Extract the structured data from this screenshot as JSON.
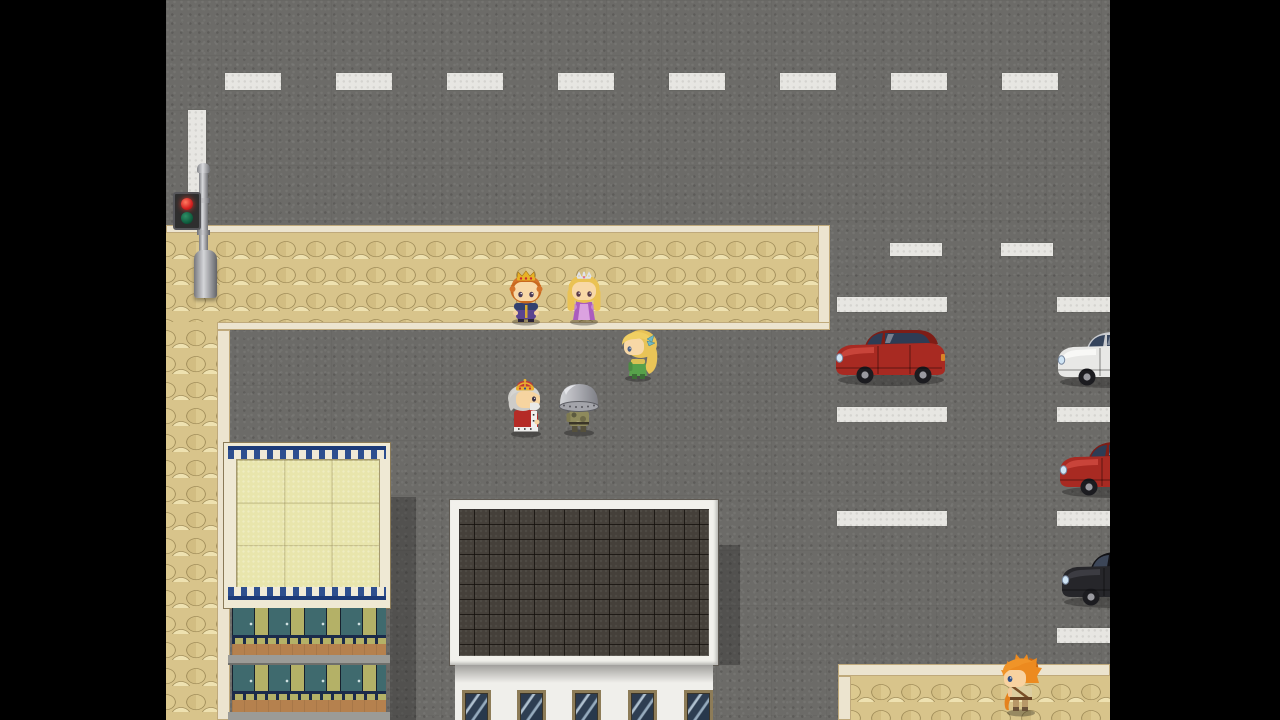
{
  "scene": {
    "title": "RPG town street scene",
    "engine_style": "top-down tile RPG (letterboxed game screen)",
    "letterbox_color": "#000000",
    "road": {
      "surface_color": "#6c6b68",
      "marking_color": "#e7e6e2",
      "top_lane_dashes": 8,
      "mid_lane_dashes": 2,
      "stop_line": "vertical white line near traffic light",
      "parking_dividers_left_column": 3,
      "parking_dividers_right_column": 4
    },
    "sidewalk": {
      "stone_light": "#eee1b0",
      "stone_mid": "#d8c48b",
      "border_color": "#ece4cf",
      "areas": [
        "upper L-shaped sidewalk",
        "left vertical strip",
        "bottom-right sidewalk"
      ]
    },
    "props": [
      {
        "id": "traffic-light",
        "label": "Traffic signal pole with red light lit",
        "state": "red"
      }
    ],
    "buildings": [
      {
        "id": "left-building",
        "label": "Apartment block: pale tiled roof with blue crenellated trim, olive floors with teal doors, brown balconies"
      },
      {
        "id": "center-building",
        "label": "Building with dark gray tiled roof, white facade and five blue windows"
      }
    ],
    "vehicles": [
      {
        "id": "red-car",
        "label": "Red sedan parked facing left",
        "color": "#a82a22"
      },
      {
        "id": "white-car",
        "label": "White car at right edge, partially off-screen",
        "color": "#e8e8e6"
      },
      {
        "id": "red-car-2",
        "label": "Red car at right edge, partially off-screen",
        "color": "#a82a22"
      },
      {
        "id": "black-car",
        "label": "Black car at right edge, partially off-screen",
        "color": "#26262a"
      }
    ],
    "characters": [
      {
        "id": "prince",
        "label": "Prince with gold crown, orange hair, purple royal outfit",
        "facing": "down"
      },
      {
        "id": "princess",
        "label": "Princess with silver tiara, blonde hair, violet dress",
        "facing": "down"
      },
      {
        "id": "blonde-girl",
        "label": "Blonde girl in green dress with teal hair ribbon",
        "facing": "left"
      },
      {
        "id": "old-king",
        "label": "Old king with red crown and ermine-trimmed red robe",
        "facing": "right"
      },
      {
        "id": "helmet-soldier",
        "label": "Soldier with large steel dome helmet and camo fatigues",
        "facing": "left"
      },
      {
        "id": "hero",
        "label": "Spiky orange-haired adventurer on lower sidewalk",
        "facing": "left"
      }
    ]
  }
}
